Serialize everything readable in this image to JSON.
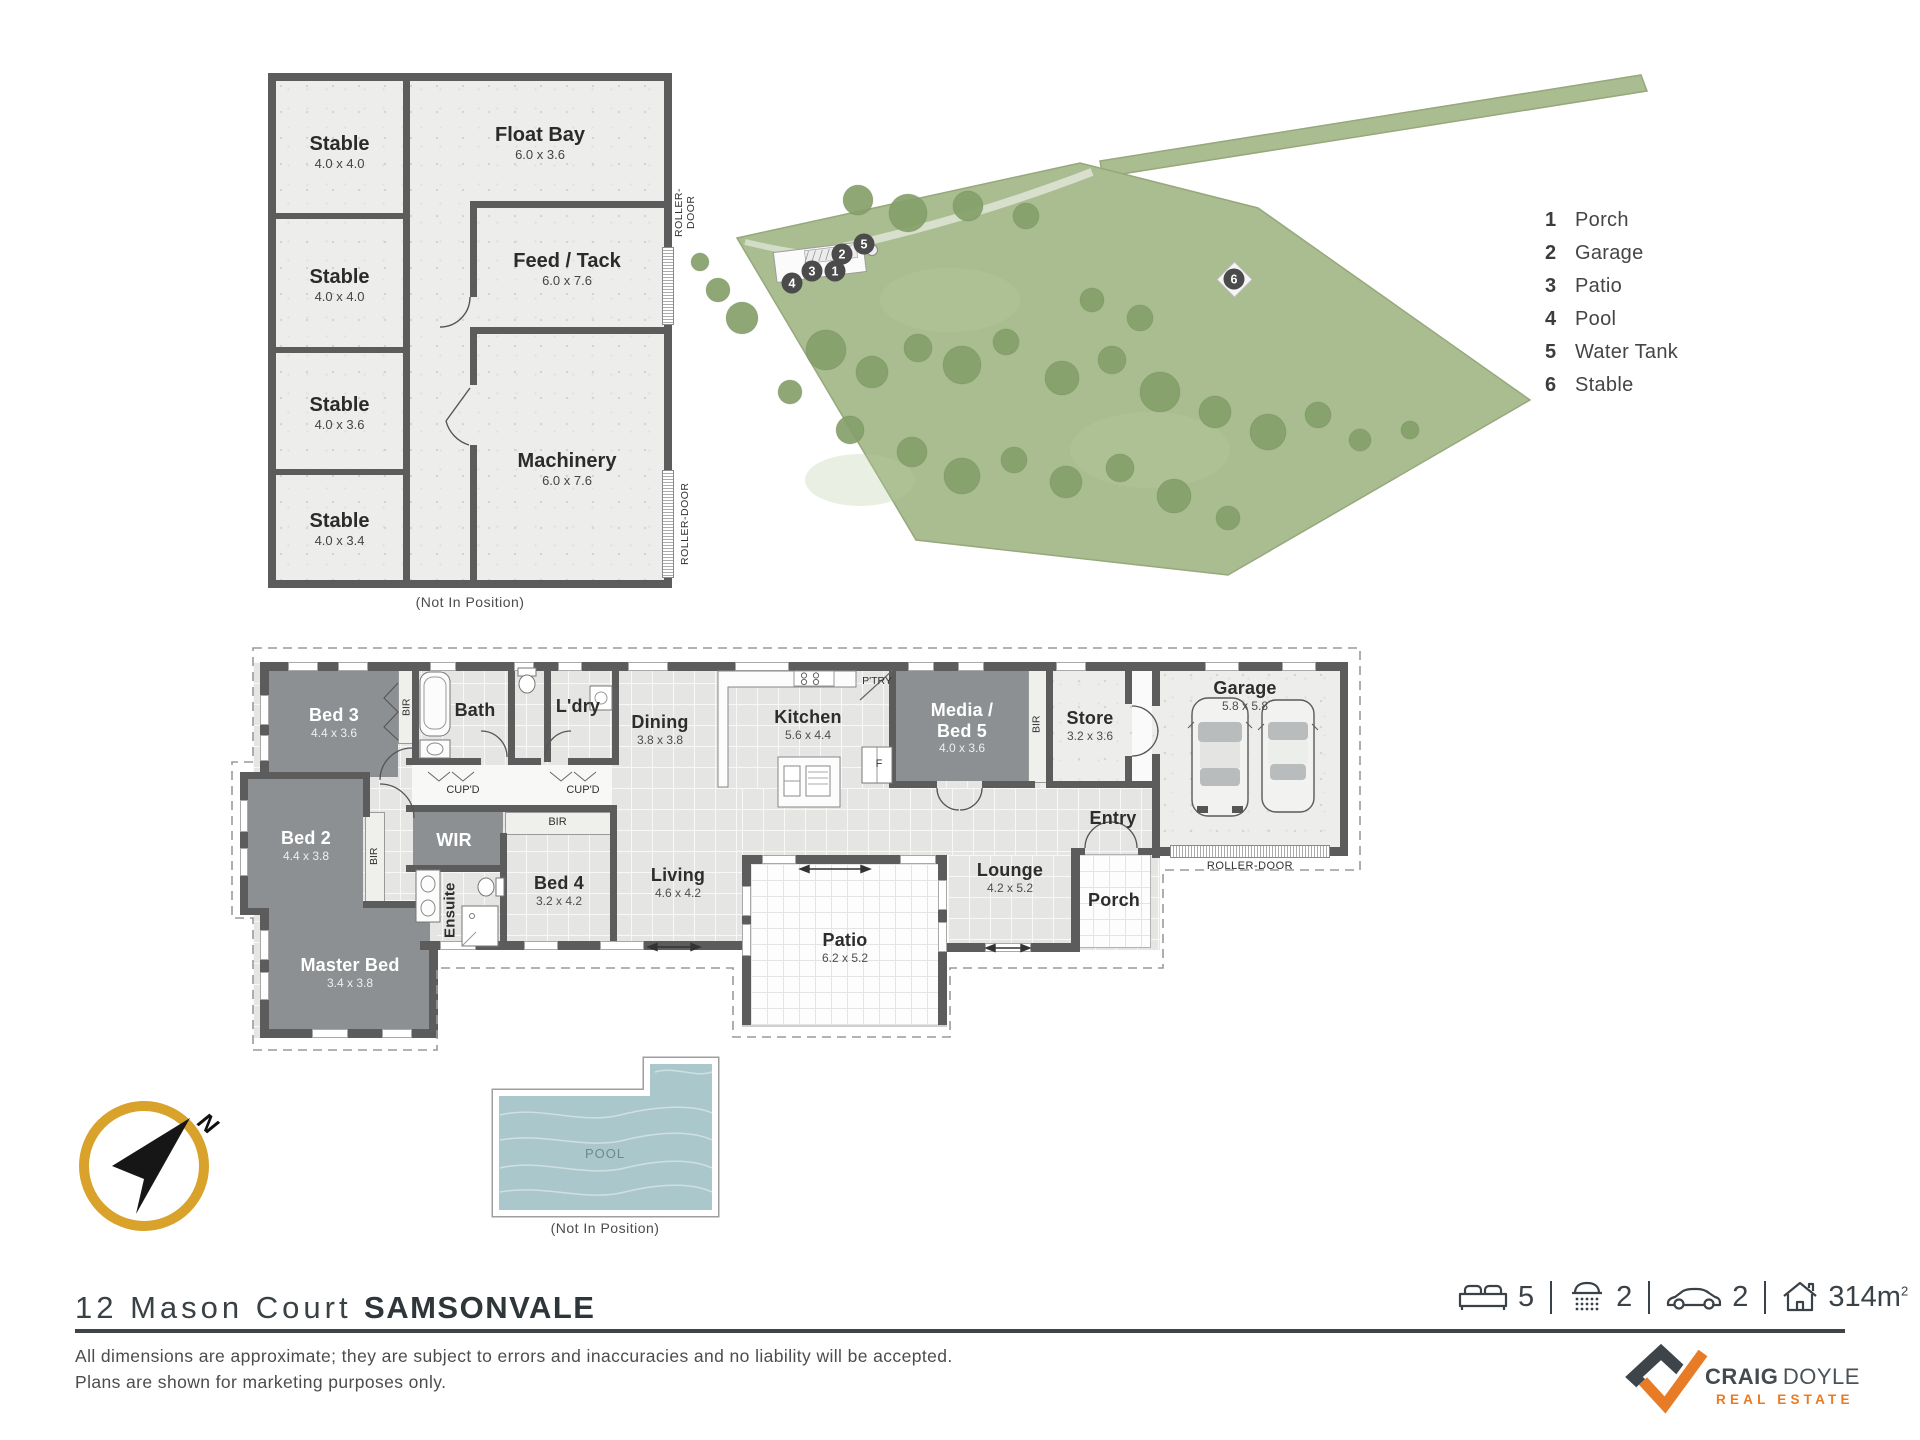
{
  "site_map": {
    "legend": [
      {
        "num": "1",
        "label": "Porch"
      },
      {
        "num": "2",
        "label": "Garage"
      },
      {
        "num": "3",
        "label": "Patio"
      },
      {
        "num": "4",
        "label": "Pool"
      },
      {
        "num": "5",
        "label": "Water Tank"
      },
      {
        "num": "6",
        "label": "Stable"
      }
    ],
    "markers": [
      "1",
      "2",
      "3",
      "4",
      "5",
      "6"
    ]
  },
  "stable_building": {
    "rooms": {
      "stable1": {
        "name": "Stable",
        "dims": "4.0 x 4.0"
      },
      "stable2": {
        "name": "Stable",
        "dims": "4.0 x 4.0"
      },
      "stable3": {
        "name": "Stable",
        "dims": "4.0 x 3.6"
      },
      "stable4": {
        "name": "Stable",
        "dims": "4.0 x 3.4"
      },
      "float_bay": {
        "name": "Float Bay",
        "dims": "6.0 x 3.6"
      },
      "feed_tack": {
        "name": "Feed / Tack",
        "dims": "6.0 x 7.6"
      },
      "machinery": {
        "name": "Machinery",
        "dims": "6.0 x 7.6"
      }
    },
    "roller_door_label": "ROLLER-DOOR",
    "note": "(Not In Position)"
  },
  "floor_plan": {
    "rooms": {
      "bed3": {
        "name": "Bed 3",
        "dims": "4.4 x 3.6"
      },
      "bed2": {
        "name": "Bed 2",
        "dims": "4.4 x 3.8"
      },
      "master_bed": {
        "name": "Master Bed",
        "dims": "3.4 x 3.8"
      },
      "wir": {
        "name": "WIR"
      },
      "ensuite": {
        "name": "Ensuite"
      },
      "bed4": {
        "name": "Bed 4",
        "dims": "3.2 x 4.2"
      },
      "living": {
        "name": "Living",
        "dims": "4.6 x 4.2"
      },
      "dining": {
        "name": "Dining",
        "dims": "3.8 x 3.8"
      },
      "kitchen": {
        "name": "Kitchen",
        "dims": "5.6 x 4.4"
      },
      "bath": {
        "name": "Bath"
      },
      "ldry": {
        "name": "L'dry"
      },
      "media_bed5": {
        "name_line1": "Media /",
        "name_line2": "Bed 5",
        "dims": "4.0 x 3.6"
      },
      "store": {
        "name": "Store",
        "dims": "3.2 x 3.6"
      },
      "garage": {
        "name": "Garage",
        "dims": "5.8 x 5.8"
      },
      "entry": {
        "name": "Entry"
      },
      "lounge": {
        "name": "Lounge",
        "dims": "4.2 x 5.2"
      },
      "porch": {
        "name": "Porch"
      },
      "patio": {
        "name": "Patio",
        "dims": "6.2 x 5.2"
      }
    },
    "small_labels": {
      "bir": "BIR",
      "cupd": "CUP'D",
      "ptry": "P'TRY",
      "fridge": "F",
      "roller_door": "ROLLER-DOOR"
    }
  },
  "pool": {
    "label": "POOL",
    "note": "(Not In Position)"
  },
  "compass": {
    "north": "N"
  },
  "footer": {
    "address_street": "12 Mason Court",
    "address_suburb": "SAMSONVALE",
    "disclaimer_line1": "All dimensions are approximate; they are subject to errors and inaccuracies and no liability will be accepted.",
    "disclaimer_line2": "Plans are shown for marketing purposes only.",
    "stats": {
      "beds": "5",
      "baths": "2",
      "cars": "2",
      "area": "314m",
      "area_sup": "2"
    },
    "brand": {
      "word1": "CRAIG",
      "word2": "DOYLE",
      "tagline": "REAL ESTATE"
    }
  },
  "colors": {
    "accent_gold": "#D8A22B",
    "brand_orange": "#E87B25",
    "brand_slate": "#3A4247",
    "site_green": "#A9BD90",
    "tree_green": "#85A06A",
    "pool_blue": "#AAC7CB",
    "wall_gray": "#5C5C5C",
    "bedroom_gray": "#8D9092"
  }
}
